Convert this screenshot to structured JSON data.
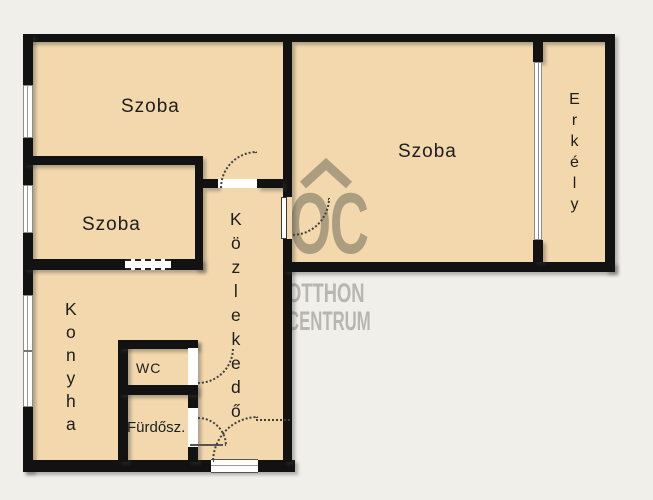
{
  "rooms": {
    "szoba_top_left": "Szoba",
    "szoba_middle_left": "Szoba",
    "szoba_main": "Szoba",
    "erkely": "Erkély",
    "kozlekedo": "Közlekedő",
    "konyha": "Konyha",
    "wc": "WC",
    "furdoszoba": "Fürdősz."
  },
  "watermark": {
    "logo": "OC",
    "line1": "OTTHON",
    "line2": "CENTRUM"
  },
  "colors": {
    "background": "#f0efea",
    "floor": "#f2d8ac",
    "wall": "#121212",
    "watermark_logo": "#ab9d7f",
    "watermark_text": "#b7b6b0",
    "label_text": "#1d1d1d"
  }
}
